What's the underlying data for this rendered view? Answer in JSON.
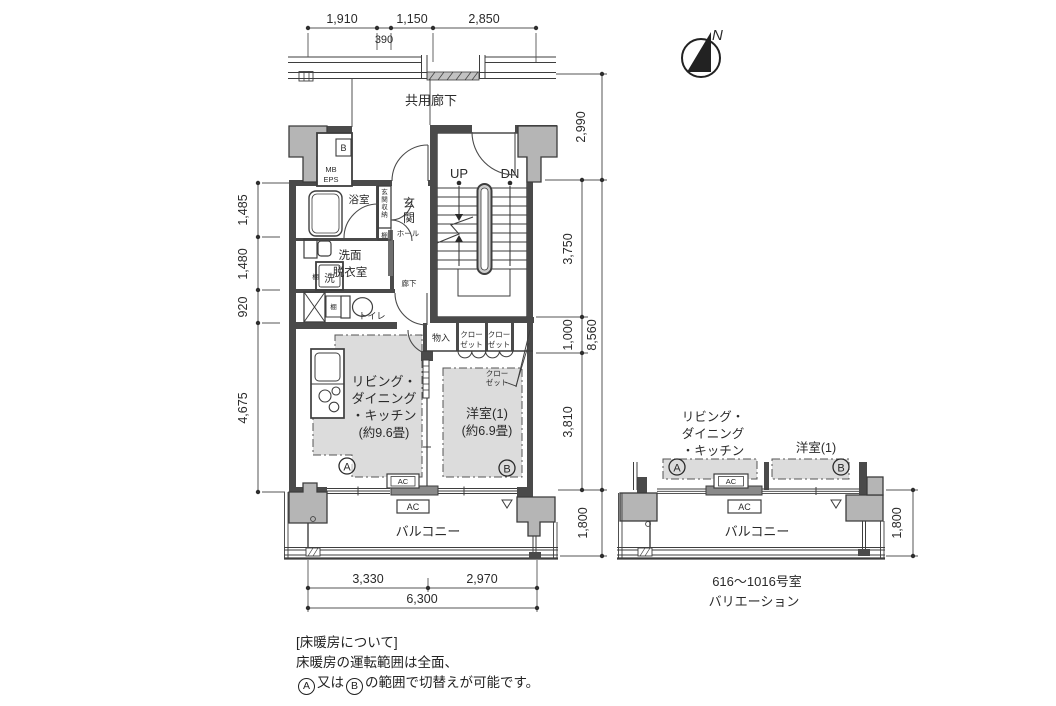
{
  "colors": {
    "line": "#3e3e3e",
    "wall": "#4a4a4a",
    "column_fill": "#b5b5b5",
    "zone_fill": "#dcdcdc",
    "slider_fill": "#8a8a8a"
  },
  "compass": {
    "north_label": "N"
  },
  "common_corridor_label": "共用廊下",
  "dimensions": {
    "top": [
      "1,910",
      "1,150",
      "2,850"
    ],
    "top_sub": "390",
    "left": [
      "1,485",
      "1,480",
      "920",
      "4,675"
    ],
    "right_outer": [
      "2,990",
      "8,560",
      "1,800"
    ],
    "right_inner": [
      "3,750",
      "1,000",
      "3,810"
    ],
    "bottom": [
      "3,330",
      "2,970"
    ],
    "bottom_total": "6,300",
    "variation_balcony_depth": "1,800"
  },
  "main_plan": {
    "meter_box_small": "B",
    "meter_box": "MB",
    "eps": "EPS",
    "bathroom": "浴室",
    "entrance_storage": "玄関収納",
    "entrance": "玄関",
    "shelf": "棚",
    "hall": "ホール",
    "washroom_line1": "洗面",
    "washroom_line2": "脱衣室",
    "washer": "洗",
    "inner_corridor": "廊下",
    "toilet": "トイレ",
    "stairs_up": "UP",
    "stairs_down": "DN",
    "storage": "物入",
    "closet_line1": "クロー",
    "closet_line2": "ゼット",
    "ldk_line1": "リビング・",
    "ldk_line2": "ダイニング",
    "ldk_line3": "・キッチン",
    "ldk_size": "(約9.6畳)",
    "western_room": "洋室(1)",
    "western_size": "(約6.9畳)",
    "zone_a": "A",
    "zone_b": "B",
    "ac": "AC",
    "balcony": "バルコニー"
  },
  "variation_plan": {
    "ldk_line1": "リビング・",
    "ldk_line2": "ダイニング",
    "ldk_line3": "・キッチン",
    "western_room": "洋室(1)",
    "zone_a": "A",
    "zone_b": "B",
    "ac": "AC",
    "balcony": "バルコニー",
    "caption_line1": "616〜1016号室",
    "caption_line2": "バリエーション"
  },
  "note": {
    "line1": "[床暖房について]",
    "line2": "床暖房の運転範囲は全面、",
    "a": "A",
    "between": "又は",
    "b": "B",
    "line3_rest": "の範囲で切替えが可能です。"
  }
}
